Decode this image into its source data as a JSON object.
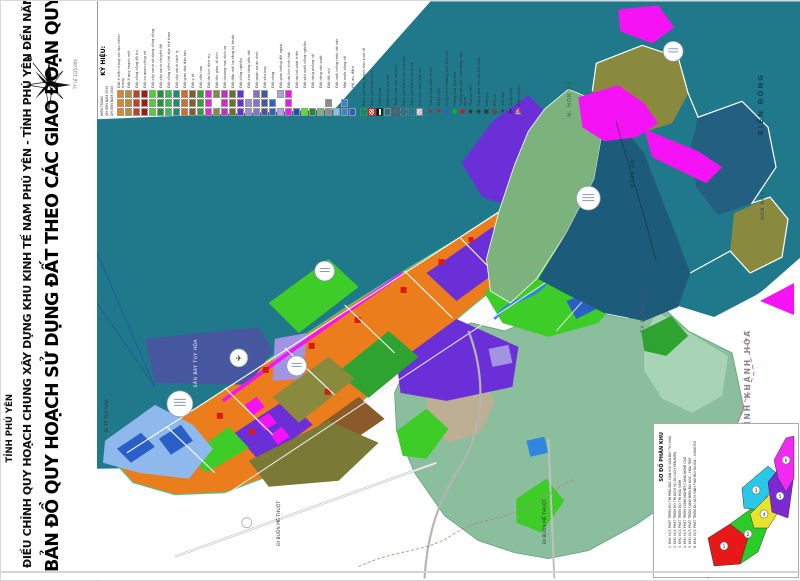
{
  "colors": {
    "sea": "#20798A",
    "urban_orange": "#EC7D1C",
    "industry_purple": "#6A2FD6",
    "airport_slate": "#46579F",
    "park_green": "#3ECC28",
    "forest_green": "#7CB37C",
    "mountain_navy": "#1D5B7B",
    "olive": "#8A8A3E",
    "sage": "#8BBE9C",
    "tourism_magenta": "#F513F5",
    "water_blue": "#2E86E0",
    "red_public": "#D81A10"
  },
  "sidebar": {
    "province": "TỈNH PHÚ YÊN",
    "subtitle": "ĐIỀU CHỈNH QUY HOẠCH CHUNG XÂY DỰNG KHU KINH TẾ NAM PHÚ YÊN - TỈNH PHÚ YÊN ĐẾN NĂM 2040",
    "title": "BẢN ĐỒ QUY HOẠCH SỬ DỤNG ĐẤT THEO CÁC GIAO ĐOẠN QUY HOẠCH",
    "compass_label": "B",
    "scale_note": "TỶ LỆ 1/25.000"
  },
  "legend": {
    "title": "KÝ HIỆU:",
    "phases": [
      "HIỆN TRẠNG",
      "QH ĐẾN NĂM 2030",
      "QH ĐẾN NĂM 2040"
    ],
    "land_use": [
      {
        "label": "Đất ở hiện trạng cải tạo chỉnh trang",
        "color": "#E8821E",
        "rows": [
          1,
          1,
          1
        ]
      },
      {
        "label": "Đất ở quy hoạch mới",
        "color": "#BA8D2F",
        "rows": [
          1,
          1,
          1
        ]
      },
      {
        "label": "Đất công cộng đô thị",
        "color": "#CE3A20",
        "rows": [
          1,
          1,
          1
        ]
      },
      {
        "label": "Đất cơ quan công sở",
        "color": "#A41A12",
        "rows": [
          1,
          1,
          1
        ]
      },
      {
        "label": "Đất cây xanh sử dụng công cộng",
        "color": "#44D62A",
        "rows": [
          1,
          1,
          1
        ]
      },
      {
        "label": "Đất cây xanh chuyên đề",
        "color": "#1E9632",
        "rows": [
          1,
          1,
          1
        ]
      },
      {
        "label": "Đất công viên thể dục thể thao",
        "color": "#2FBE55",
        "rows": [
          1,
          1,
          1
        ]
      },
      {
        "label": "Đất cây xanh cách ly",
        "color": "#1D8A72",
        "rows": [
          1,
          1,
          1
        ]
      },
      {
        "label": "Đất giáo dục đào tạo",
        "color": "#DE6A1A",
        "rows": [
          1,
          1,
          1
        ]
      },
      {
        "label": "Đất y tế",
        "color": "#8B5A2B",
        "rows": [
          1,
          1,
          1
        ]
      },
      {
        "label": "Đất hỗn hợp",
        "color": "#2FA32F",
        "rows": [
          1,
          1,
          1
        ]
      },
      {
        "label": "Đất du lịch dịch vụ",
        "color": "#E626D6",
        "rows": [
          1,
          1,
          1
        ]
      },
      {
        "label": "Đất tôn giáo, di tích",
        "color": "#8A8A3E",
        "rows": [
          1,
          0,
          1
        ]
      },
      {
        "label": "Đất thương mại dịch vụ",
        "color": "#CD28CD",
        "rows": [
          1,
          1,
          1
        ]
      },
      {
        "label": "Đất đầu mối hạ tầng kỹ thuật",
        "color": "#6E6E2A",
        "rows": [
          1,
          1,
          1
        ]
      },
      {
        "label": "Đất công nghiệp",
        "color": "#6A2FD6",
        "rows": [
          1,
          1,
          1
        ]
      },
      {
        "label": "Đất kho tàng bến bãi",
        "color": "#9B8CD9",
        "rows": [
          0,
          1,
          1
        ]
      },
      {
        "label": "Đất quân sự an ninh",
        "color": "#8273C8",
        "rows": [
          1,
          1,
          1
        ]
      },
      {
        "label": "Đất sân bay",
        "color": "#46579F",
        "rows": [
          1,
          1,
          1
        ]
      },
      {
        "label": "Đất cảng",
        "color": "#2A62C8",
        "rows": [
          0,
          1,
          1
        ]
      },
      {
        "label": "Đất giao thông đối ngoại",
        "color": "#AF9FE8",
        "rows": [
          1,
          0,
          1
        ]
      },
      {
        "label": "Đất du lịch sinh thái",
        "color": "#F513F5",
        "rows": [
          1,
          1,
          1
        ]
      },
      {
        "label": "Đất dự trữ phát triển",
        "color": "#1B4FB0",
        "rows": [
          0,
          0,
          1
        ]
      }
    ],
    "nature": [
      {
        "label": "Đất sản xuất nông nghiệp",
        "color": "#55E818",
        "rows": [
          0,
          0,
          1
        ]
      },
      {
        "label": "Đất rừng phòng hộ",
        "color": "#1E8C28",
        "rows": [
          0,
          0,
          1
        ]
      },
      {
        "label": "Đất rừng sản xuất",
        "color": "#7CB37C",
        "rows": [
          0,
          0,
          1
        ]
      },
      {
        "label": "Đất đồi núi",
        "color": "#8C8C8C",
        "rows": [
          0,
          1,
          1
        ]
      },
      {
        "label": "Đất nuôi trồng thủy hải sản",
        "color": "#79C8F0",
        "rows": [
          0,
          0,
          1
        ]
      },
      {
        "label": "Mặt nước sông hồ",
        "color": "#2E86E0",
        "rows": [
          0,
          1,
          1
        ]
      },
      {
        "label": "Hồ, ao, đầm",
        "color": "#2A5FC8",
        "rows": [
          0,
          0,
          1
        ]
      }
    ],
    "overlay": [
      {
        "label": "Ranh giới quy hoạch khu kinh tế",
        "style": "solid-green"
      },
      {
        "label": "Ranh giới phân khu",
        "style": "hatch-red"
      },
      {
        "label": "Đường sắt",
        "style": "rail"
      },
      {
        "label": "Đường bộ cao tốc",
        "style": "line-gray"
      },
      {
        "label": "Tuyến cáp treo dự kiến",
        "style": "dash-red"
      },
      {
        "label": "Ranh giới hành chính huyện",
        "style": "dash-gray"
      },
      {
        "label": "Ranh giới hành chính xã",
        "style": "dot-gray"
      },
      {
        "label": "Khu vực khai thác cát",
        "style": "hatch-gray"
      }
    ],
    "symbols": [
      {
        "label": "Trung tâm hành chính",
        "glyph": "★",
        "color": "#D01818"
      },
      {
        "label": "Bệnh viện",
        "glyph": "✚",
        "color": "#D01818"
      },
      {
        "label": "Công trình thương mại dịch vụ",
        "glyph": "●",
        "color": "#2A62C8"
      },
      {
        "label": "Trung tâm văn hóa",
        "glyph": "●",
        "color": "#28A828"
      },
      {
        "label": "Trường đại học, cao đẳng, dạy nghề",
        "glyph": "●",
        "color": "#D01818"
      },
      {
        "label": "Trường THPT",
        "glyph": "◆",
        "color": "#333333"
      },
      {
        "label": "Trung tâm thể dục thể thao",
        "glyph": "◉",
        "color": "#333333"
      },
      {
        "label": "Nhà ga",
        "glyph": "▣",
        "color": "#333333"
      },
      {
        "label": "Bến xe",
        "glyph": "⬤",
        "color": "#555555"
      },
      {
        "label": "Sân bay",
        "glyph": "✈",
        "color": "#222222"
      },
      {
        "label": "Cảng biển",
        "glyph": "⚓",
        "color": "#222222"
      },
      {
        "label": "Bến thuyền",
        "glyph": "⛵",
        "color": "#222222"
      }
    ]
  },
  "map": {
    "labels": {
      "sea": "BIỂN ĐÔNG",
      "hon_nua": "HÒN NƯA",
      "hon_ba": "N. HÒN BÀ",
      "vung_ro": "VŨNG RÔ",
      "khanh_hoa": "TỈNH KHÁNH HÒA",
      "dong_hoa": "TX ĐÔNG HÒA",
      "airport": "SÂN BAY TUY HÒA",
      "road_tuy_hoa": "ĐI TP TUY HÒA",
      "road_bmt_1": "ĐI BUÔN MÊ THUỘT",
      "road_bmt_2": "ĐI BUÔN MÊ THUỘT"
    }
  },
  "inset": {
    "title": "SƠ ĐỒ PHÂN KHU",
    "zones": [
      {
        "n": "1",
        "label": "1. KHU VỰC PHÁT TRIỂN ĐÔ THỊ PHÍA BẮC GẮN VỚI SÂN BAY TUY HÒA",
        "color": "#E81818"
      },
      {
        "n": "2",
        "label": "2. KHU VỰC PHÁT TRIỂN ĐÔ THỊ DỊCH VỤ DU LỊCH VEN BIỂN",
        "color": "#2ACC2A"
      },
      {
        "n": "3",
        "label": "3. KHU VỰC PHÁT TRIỂN ĐÔ THỊ HÒA VINH",
        "color": "#2AC8E8"
      },
      {
        "n": "4",
        "label": "4. KHU VỰC PHÁT TRIỂN CÔNG NGHIỆP CÔNG NGHỆ CAO",
        "color": "#E8E22A"
      },
      {
        "n": "5",
        "label": "5. KHU VỰC PHÁT TRIỂN CẢNG BIỂN BÃI GỐC - HÒA TÂM",
        "color": "#7A2AD0"
      },
      {
        "n": "6",
        "label": "6. KHU VỰC PHÁT TRIỂN DU LỊCH SINH THÁI NÚI ĐÁ BIA - VŨNG RÔ",
        "color": "#F02AF0"
      }
    ]
  }
}
